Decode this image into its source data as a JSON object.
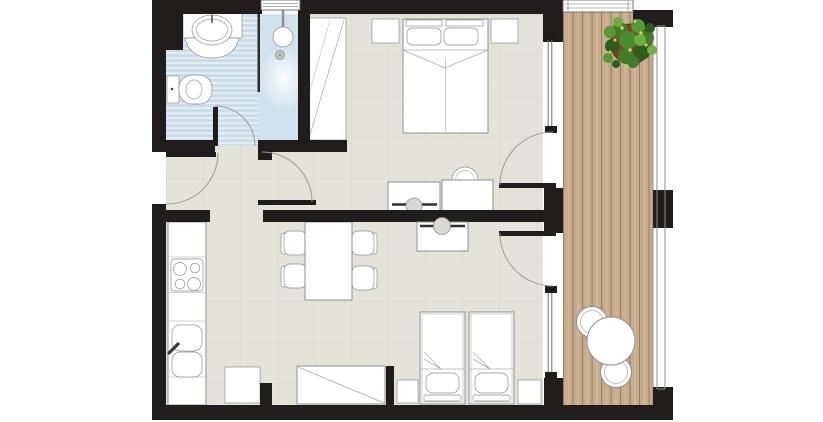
{
  "meta": {
    "type": "apartment-floor-plan",
    "canvas_width_px": 823,
    "canvas_height_px": 422,
    "visible_text": "none"
  },
  "colors": {
    "background": "#ffffff",
    "wall": "#201d1c",
    "floor": "#e4e3da",
    "bath_tile_a": "#cbdde9",
    "bath_tile_b": "#e7f0f6",
    "shower": "#cfe2ee",
    "deck_plank": "#c6ac8c",
    "deck_line": "#9a7f5c",
    "deck_streak": "#cfb797",
    "furniture_fill": "#ffffff",
    "furniture_stroke": "#8f8f8f",
    "door_arc": "#9a9a9a",
    "stool_fill": "#d9d9d4",
    "plant_pot": "#8e3b2b"
  },
  "rooms": [
    {
      "name": "bathroom",
      "floor": "blue striped tile",
      "fixtures": [
        "vanity-counter",
        "oval-sink",
        "toilet",
        "shower",
        "shower-head",
        "floor-drain",
        "window"
      ]
    },
    {
      "name": "bedroom",
      "furniture": [
        "double-bed",
        "two-pillows",
        "nightstand-left",
        "nightstand-right",
        "wardrobe",
        "desk-with-stool",
        "dressing-table-with-chair",
        "balcony-window",
        "balcony-door"
      ]
    },
    {
      "name": "hallway",
      "features": [
        "entrance-door",
        "bathroom-door",
        "bedroom-door"
      ]
    },
    {
      "name": "living-room-with-kitchenette",
      "furniture": [
        "kitchen-counter",
        "stove-4-burners",
        "double-sink",
        "base-cabinet",
        "dining-table",
        "four-chairs",
        "desk-with-stool",
        "wardrobe",
        "twin-bed-1",
        "twin-bed-2",
        "nightstands",
        "balcony-window",
        "balcony-door"
      ]
    },
    {
      "name": "balcony",
      "features": [
        "wood-deck",
        "railing",
        "potted-plant",
        "round-table",
        "two-round-chairs",
        "top-window"
      ]
    }
  ]
}
